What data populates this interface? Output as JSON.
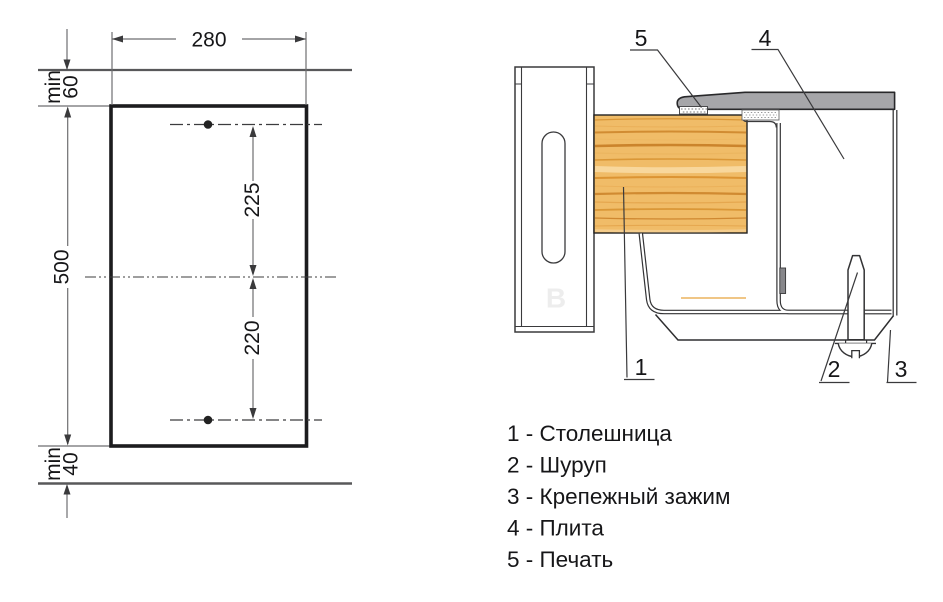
{
  "left_drawing": {
    "width_dim": "280",
    "height_dim": "500",
    "top_margin_word": "min",
    "top_margin_value": "60",
    "bottom_margin_word": "min",
    "bottom_margin_value": "40",
    "upper_hole_dim": "225",
    "lower_hole_dim": "220"
  },
  "section_view": {
    "callout_1": "1",
    "callout_2": "2",
    "callout_3": "3",
    "callout_4": "4",
    "callout_5": "5",
    "watermark": "B"
  },
  "legend": {
    "items": [
      {
        "label": "1 - Столешница"
      },
      {
        "label": "2 - Шуруп"
      },
      {
        "label": "3 - Крепежный зажим"
      },
      {
        "label": "4 - Плита"
      },
      {
        "label": "5 - Печать"
      }
    ]
  },
  "colors": {
    "wood": "#f0bc68",
    "top_plate": "#a6a6a9",
    "clamp_bar": "#87878b",
    "accent_line": "#e8a33d",
    "outline": "#2e2e30",
    "dim_line": "#6e6e70"
  }
}
